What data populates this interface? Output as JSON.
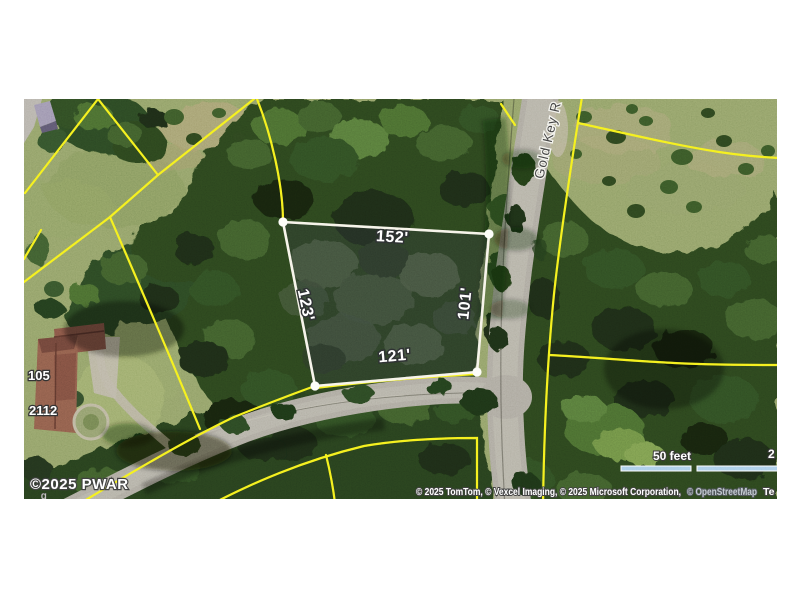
{
  "map": {
    "parcel": {
      "dim_top": "152'",
      "dim_left": "123'",
      "dim_right": "101'",
      "dim_bottom": "121'",
      "outline_color": "#f6f3e8"
    },
    "road_label": "Gold Key R",
    "house_numbers": [
      "105",
      "2112"
    ],
    "watermark": {
      "text": "©2025 PWAR",
      "fragment": "g"
    },
    "boundary_color": "#f4ef1c",
    "scale_bar": {
      "feet": "50 feet",
      "meters_fragment": "2",
      "color": "#a6cbe8"
    },
    "attribution": {
      "providers": "© 2025 TomTom, © Vexcel Imaging, © 2025 Microsoft Corporation,",
      "osm": "© OpenStreetMap",
      "terms": "Te"
    }
  }
}
